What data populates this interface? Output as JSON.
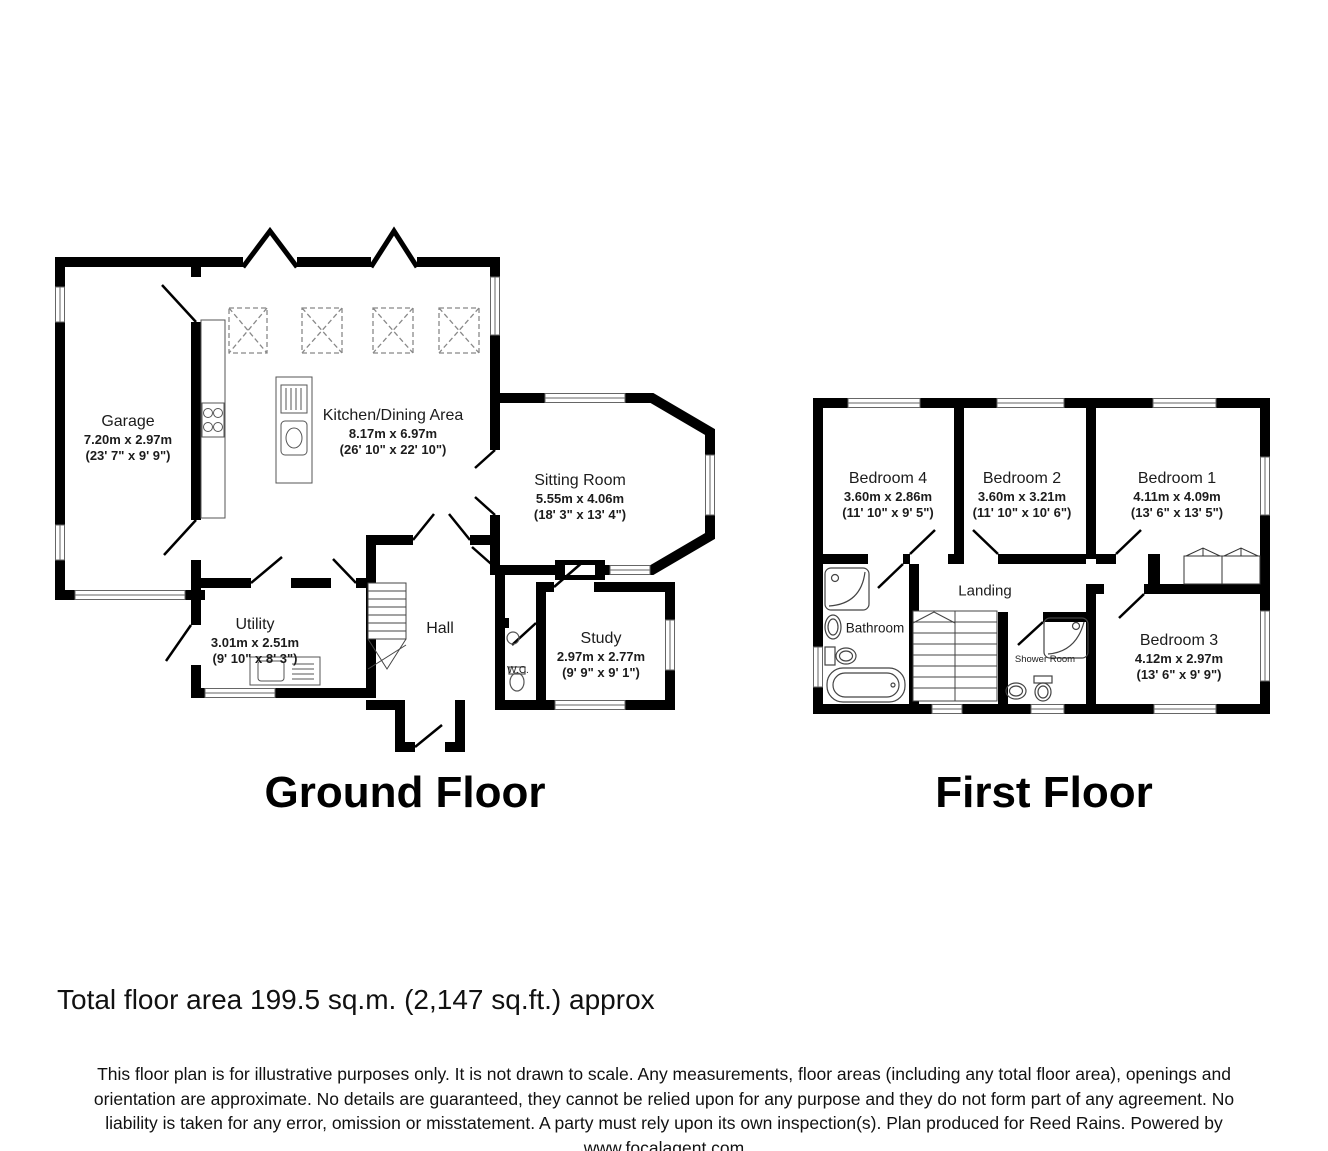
{
  "ground_floor": {
    "title": "Ground Floor",
    "rooms": {
      "garage": {
        "name": "Garage",
        "dims_m": "7.20m x 2.97m",
        "dims_ft": "(23' 7\" x 9' 9\")"
      },
      "kitchen": {
        "name": "Kitchen/Dining Area",
        "dims_m": "8.17m x 6.97m",
        "dims_ft": "(26' 10\" x 22' 10\")"
      },
      "sitting": {
        "name": "Sitting Room",
        "dims_m": "5.55m x 4.06m",
        "dims_ft": "(18' 3\" x 13' 4\")"
      },
      "utility": {
        "name": "Utility",
        "dims_m": "3.01m x 2.51m",
        "dims_ft": "(9' 10\" x 8' 3\")"
      },
      "hall": {
        "name": "Hall"
      },
      "wc": {
        "name": "W.C."
      },
      "study": {
        "name": "Study",
        "dims_m": "2.97m x 2.77m",
        "dims_ft": "(9' 9\" x 9' 1\")"
      }
    }
  },
  "first_floor": {
    "title": "First Floor",
    "rooms": {
      "bedroom4": {
        "name": "Bedroom 4",
        "dims_m": "3.60m x 2.86m",
        "dims_ft": "(11' 10\" x 9' 5\")"
      },
      "bedroom2": {
        "name": "Bedroom 2",
        "dims_m": "3.60m x 3.21m",
        "dims_ft": "(11' 10\" x 10' 6\")"
      },
      "bedroom1": {
        "name": "Bedroom 1",
        "dims_m": "4.11m x 4.09m",
        "dims_ft": "(13' 6\" x 13' 5\")"
      },
      "bathroom": {
        "name": "Bathroom"
      },
      "landing": {
        "name": "Landing"
      },
      "shower": {
        "name": "Shower Room"
      },
      "bedroom3": {
        "name": "Bedroom 3",
        "dims_m": "4.12m x 2.97m",
        "dims_ft": "(13' 6\" x 9' 9\")"
      }
    }
  },
  "footer": {
    "total_area": "Total floor area 199.5 sq.m. (2,147 sq.ft.) approx",
    "disclaimer_lines": [
      "This floor plan is for illustrative purposes only. It is not drawn to scale. Any measurements, floor areas (including any total floor area), openings and",
      "orientation are approximate. No details are guaranteed, they cannot be relied upon for any purpose and they do not form part of any agreement. No",
      "liability is taken for any error, omission or misstatement. A party must rely upon its own inspection(s). Plan produced for Reed Rains. Powered by",
      "www.focalagent.com"
    ]
  },
  "colors": {
    "wall": "#000000",
    "text": "#111111",
    "background": "#ffffff",
    "fixture_line": "#444444",
    "skylight_dash": "#888888"
  }
}
